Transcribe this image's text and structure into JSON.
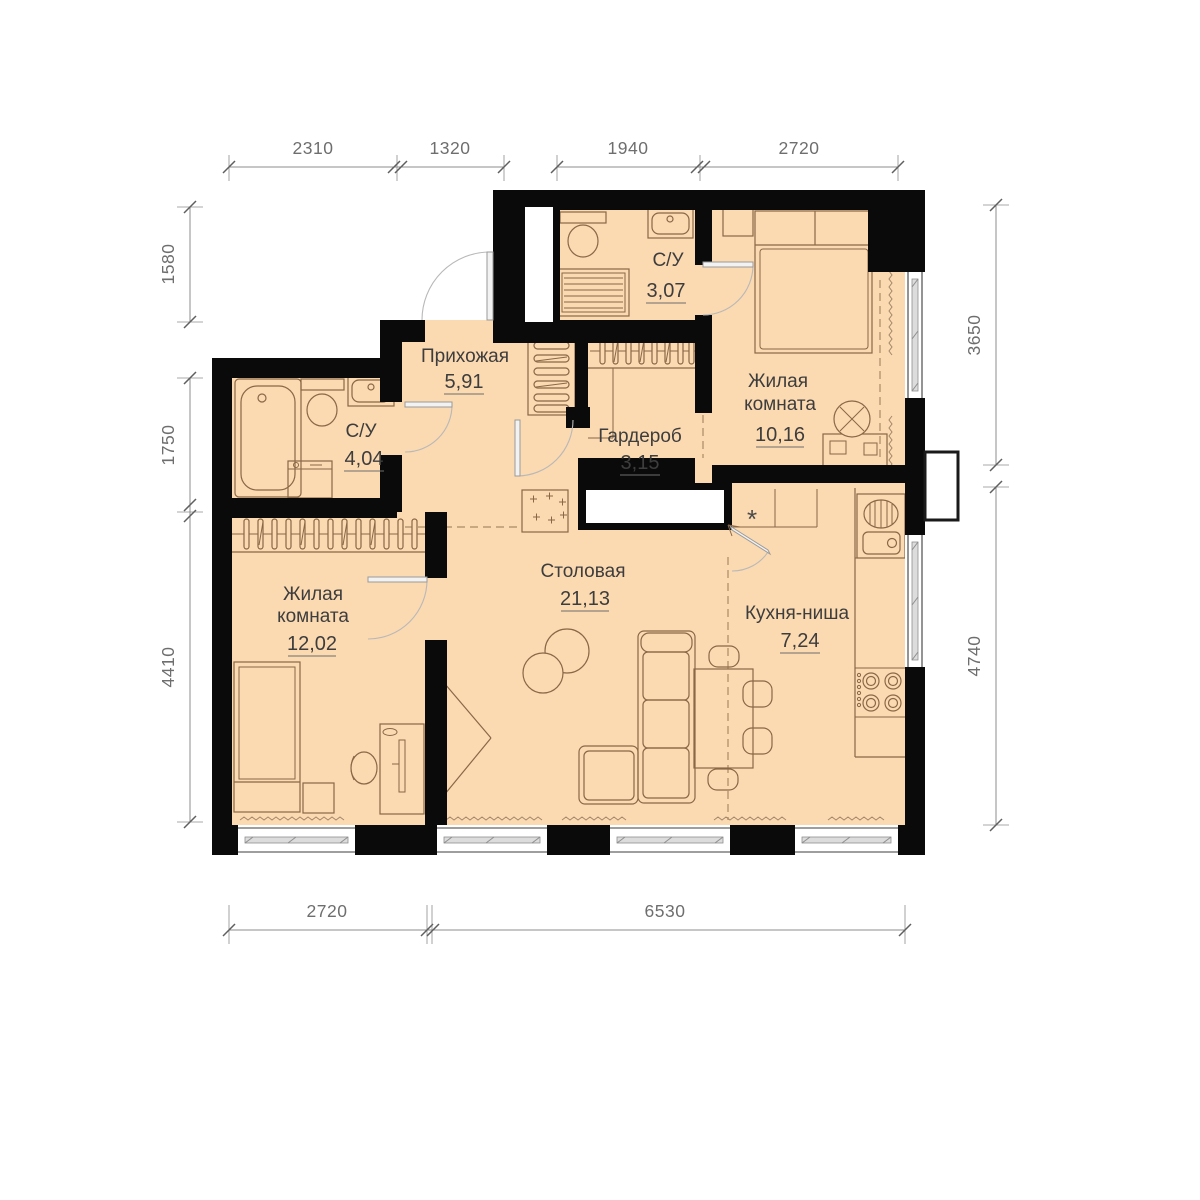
{
  "plan": {
    "colors": {
      "background": "#ffffff",
      "floor": "#fbd9b1",
      "wall": "#0a0a0a",
      "furniture": "#8a6847",
      "dimension": "#6e6e6e",
      "label": "#3d3d3d"
    },
    "rooms": [
      {
        "id": "bath-top",
        "name_lines": [
          "С/У"
        ],
        "area": "3,07"
      },
      {
        "id": "bedroom-top",
        "name_lines": [
          "Жилая",
          "комната"
        ],
        "area": "10,16"
      },
      {
        "id": "hallway",
        "name_lines": [
          "Прихожая"
        ],
        "area": "5,91"
      },
      {
        "id": "bath-left",
        "name_lines": [
          "С/У"
        ],
        "area": "4,04"
      },
      {
        "id": "wardrobe",
        "name_lines": [
          "Гардероб"
        ],
        "area": "3,15"
      },
      {
        "id": "bedroom-bottom",
        "name_lines": [
          "Жилая",
          "комната"
        ],
        "area": "12,02"
      },
      {
        "id": "dining",
        "name_lines": [
          "Столовая"
        ],
        "area": "21,13"
      },
      {
        "id": "kitchen",
        "name_lines": [
          "Кухня-ниша"
        ],
        "area": "7,24"
      }
    ],
    "dimensions": {
      "top": [
        "2310",
        "1320",
        "1940",
        "2720"
      ],
      "left": [
        "1580",
        "1750",
        "4410"
      ],
      "right": [
        "3650",
        "4740"
      ],
      "bottom": [
        "2720",
        "6530"
      ]
    },
    "symbols": {
      "vent": "*"
    }
  }
}
